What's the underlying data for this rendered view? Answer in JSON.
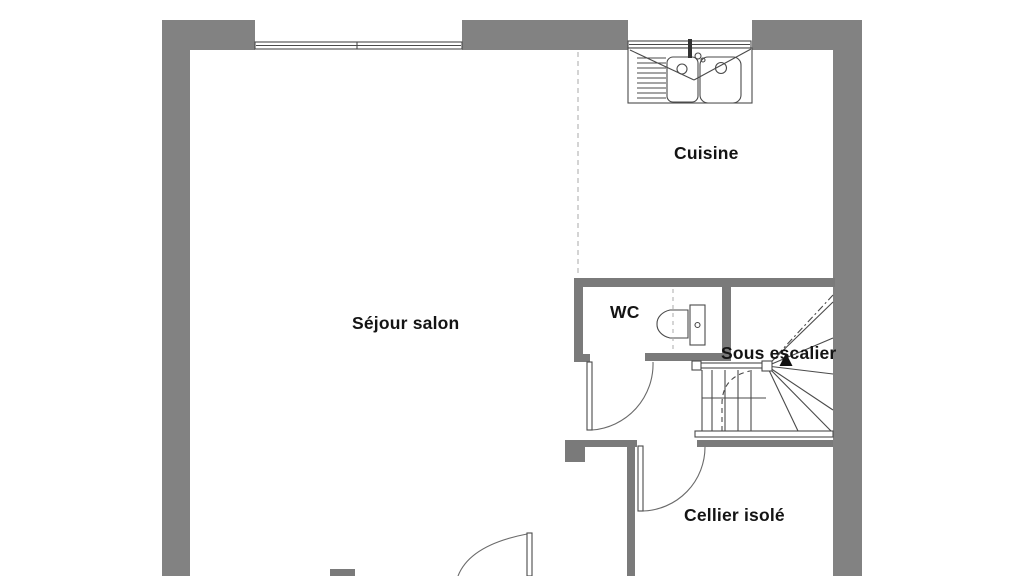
{
  "plan": {
    "type": "floor-plan",
    "labels": {
      "cuisine": "Cuisine",
      "sejour": "Séjour salon",
      "wc": "WC",
      "sous_escalier": "Sous escalier",
      "cellier": "Cellier isolé"
    },
    "rooms": [
      {
        "id": "cuisine",
        "label": "Cuisine"
      },
      {
        "id": "sejour",
        "label": "Séjour salon"
      },
      {
        "id": "wc",
        "label": "WC"
      },
      {
        "id": "sous_escalier",
        "label": "Sous escalier"
      },
      {
        "id": "cellier",
        "label": "Cellier isolé"
      }
    ],
    "fixtures": [
      "kitchen-double-sink-icon",
      "toilet-icon",
      "winder-staircase",
      "door-swing",
      "window"
    ],
    "colors": {
      "exterior_wall": "#828282",
      "interior_wall": "#7a7a7a",
      "line": "#4a4a4a",
      "dashed_line": "#b9b9b9",
      "text": "#141414",
      "background": "#ffffff"
    }
  }
}
